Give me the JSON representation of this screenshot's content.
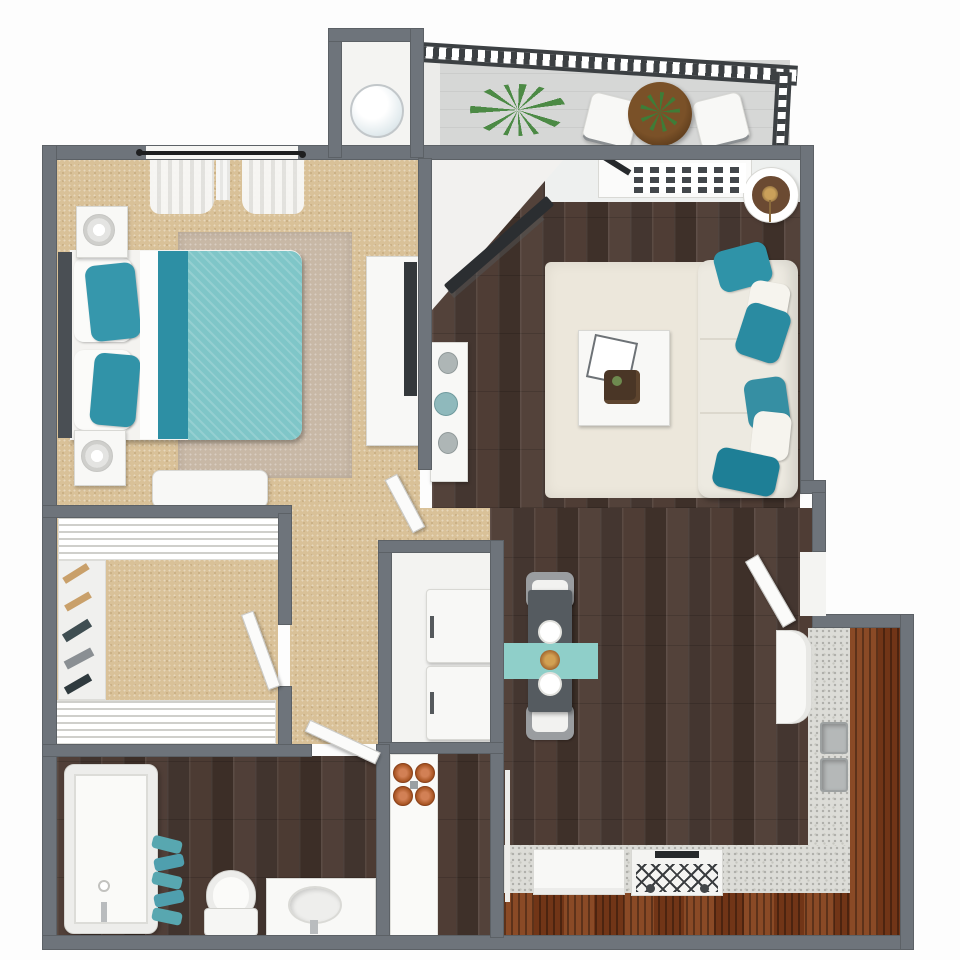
{
  "image_type": "3d-top-down-floor-plan",
  "text_on_image": "none",
  "palette": {
    "background": "#ffffff",
    "wall_gray": "#6e747b",
    "carpet_tan": "#d9c198",
    "wood_floor_dark_brown": "#4b3c34",
    "kitchen_bar_mahogany": "#7e3e1e",
    "countertop_granite": "#dcdcd7",
    "accent_teal_dark": "#2d8fa4",
    "accent_teal_light": "#7fc6c8",
    "cream_rug": "#ece7db",
    "bedroom_rug": "#c8b8a6",
    "balcony_floor": "#d6d7d6",
    "fixture_white": "#f8f8f6",
    "burner_copper": "#bf6a3f",
    "plant_green": "#4c8a45"
  },
  "rooms": [
    {
      "name": "bedroom",
      "floor": "tan-carpet",
      "furniture": [
        "double-bed-teal-bedding",
        "headboard",
        "nightstand-with-lamp-top",
        "nightstand-with-lamp-bottom",
        "area-rug",
        "foot-bench",
        "dresser",
        "dresser-tv",
        "window-with-curtains",
        "door-to-hall"
      ]
    },
    {
      "name": "walk-in-closet",
      "floor": "tan-carpet",
      "furniture": [
        "wire-shelf-top",
        "wire-shelf-bottom",
        "hanging-clothes-rail",
        "closet-door"
      ]
    },
    {
      "name": "hallway",
      "floor": "tan-carpet",
      "furniture": []
    },
    {
      "name": "bathroom",
      "floor": "dark-wood",
      "furniture": [
        "bathtub",
        "towel-stack-teal",
        "toilet",
        "sink-vanity",
        "bathroom-door"
      ]
    },
    {
      "name": "laundry-closet",
      "floor": "white",
      "furniture": [
        "washer",
        "dryer"
      ]
    },
    {
      "name": "utility-nook",
      "floor": "dark-wood",
      "furniture": [
        "white-counter-strip",
        "electric-cooktop-4-copper-burners"
      ]
    },
    {
      "name": "water-heater-closet",
      "floor": "white",
      "furniture": [
        "round-water-heater"
      ]
    },
    {
      "name": "living-room",
      "floor": "dark-wood",
      "furniture": [
        "sofa-ivory",
        "teal-throw-pillows",
        "cream-shag-rug",
        "coffee-table-with-tray",
        "console-table-with-vases",
        "angled-wall-tv",
        "entry-vent-console",
        "round-planter",
        "entry-door"
      ]
    },
    {
      "name": "dining-area",
      "floor": "dark-wood",
      "furniture": [
        "dining-table-dark",
        "teal-table-runner",
        "two-place-settings",
        "centerpiece",
        "chair-top",
        "chair-bottom"
      ]
    },
    {
      "name": "kitchen",
      "floor": "dark-wood",
      "furniture": [
        "l-shaped-granite-counter",
        "mahogany-bar-top",
        "double-basin-sink",
        "refrigerator",
        "dishwasher",
        "range-with-grates"
      ]
    },
    {
      "name": "balcony",
      "floor": "gray-concrete",
      "furniture": [
        "black-slat-railing",
        "round-bistro-table",
        "patio-chair-left",
        "patio-chair-right",
        "table-plant",
        "fern-planter"
      ]
    }
  ]
}
